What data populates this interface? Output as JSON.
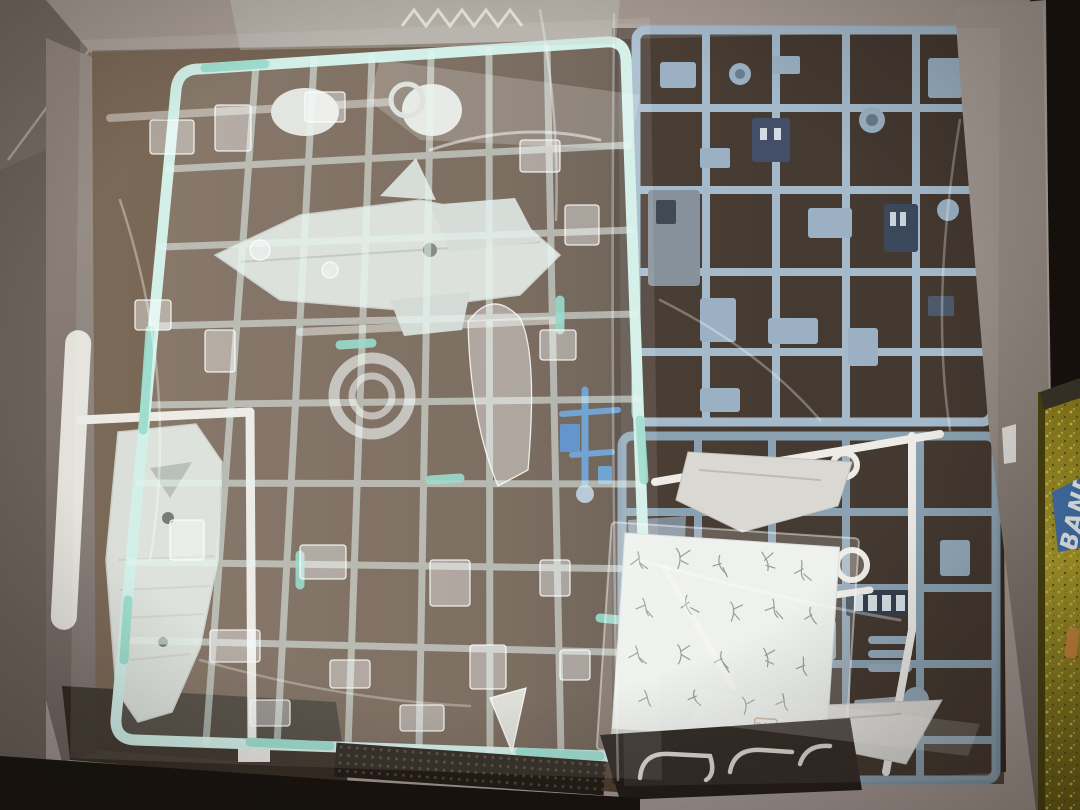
{
  "scene": {
    "type": "photograph",
    "subject": "Opened Bandai plastic model kit box, viewed from above, containing plastic-bagged part runners (sprues) and a water-slide decal sheet",
    "palette": {
      "floor_dark": "#1a1510",
      "cardboard_light": "#a59a93",
      "cardboard_shadow": "#6b615b",
      "interior_brown": "#67533f",
      "interior_shadow": "#352a21",
      "clear_sprue_tint": "#cdeee6",
      "clear_sprue_accent": "#8fd8c6",
      "white_parts": "#d9ded7",
      "white_runner": "#eceae4",
      "blue_sprue_upper": "#9db5c7",
      "blue_sprue_lower": "#8099ab",
      "navy_accent": "#32415a",
      "bright_blue_part": "#4e8cc9",
      "decal_paper": "#edf0ec",
      "decal_pattern_green": "#7b8b7a",
      "stamp_beige": "#c7b290",
      "gold_foil": "#9a8c22",
      "label_blue": "#4474ad",
      "orange_sliver": "#cf8a3e"
    },
    "objects": {
      "box": "grey cardboard kit box tray",
      "clear_sprue": "large clear aqua-tinted runner in plastic bag (left/center)",
      "white_sprues": "white runners with armor and ship-hull parts behind the clear runner",
      "blue_sprue_upper": "light blue runner in bag (upper right)",
      "blue_sprue_lower": "light blue runner in bag (lower right)",
      "white_wing_runner": "white runner with wing parts over the lower blue runner",
      "bright_blue_runner": "small bright blue runner fragment (center)",
      "decal_sheet": "white water-slide decal sheet with thin green branch-shaped markings",
      "gold_box": "gold glitter-foil box edge outside the tray (far right)"
    }
  },
  "decal_sheet": {
    "logo_line1": "BAN",
    "logo_line2": "DAI"
  },
  "side_label": {
    "brand": "BANDAI"
  }
}
